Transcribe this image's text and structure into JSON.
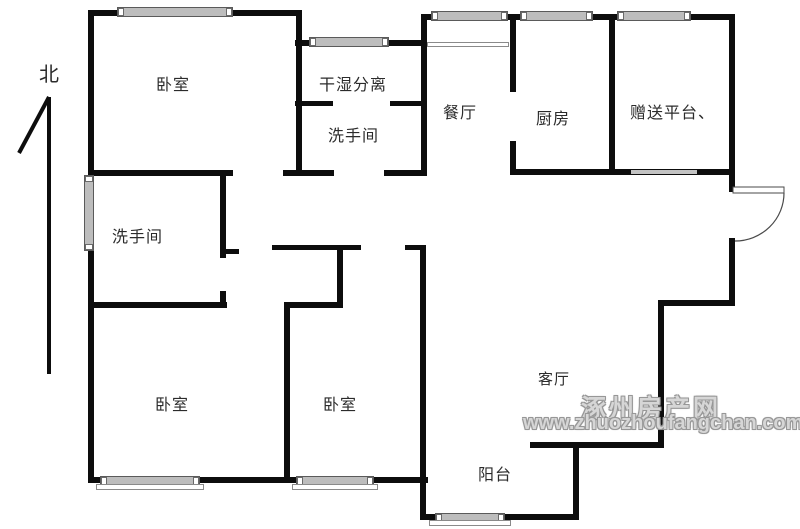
{
  "compass": {
    "label": "北"
  },
  "rooms": [
    {
      "id": "bedroom-northwest",
      "label": "卧室"
    },
    {
      "id": "dry-wet-separation",
      "label": "干湿分离"
    },
    {
      "id": "bathroom-north",
      "label": "洗手间"
    },
    {
      "id": "dining-room",
      "label": "餐厅"
    },
    {
      "id": "kitchen",
      "label": "厨房"
    },
    {
      "id": "gift-platform",
      "label": "赠送平台、"
    },
    {
      "id": "bathroom-west",
      "label": "洗手间"
    },
    {
      "id": "bedroom-southwest",
      "label": "卧室"
    },
    {
      "id": "bedroom-south",
      "label": "卧室"
    },
    {
      "id": "living-room",
      "label": "客厅"
    },
    {
      "id": "balcony",
      "label": "阳台"
    }
  ],
  "watermark": {
    "site_name": "涿州房产网",
    "site_url": "www.zhuozhoufangchan.com"
  },
  "colors": {
    "wall": "#0d0d0d",
    "window": "#bdbdbd",
    "watermark": "#979797",
    "background": "#ffffff"
  }
}
